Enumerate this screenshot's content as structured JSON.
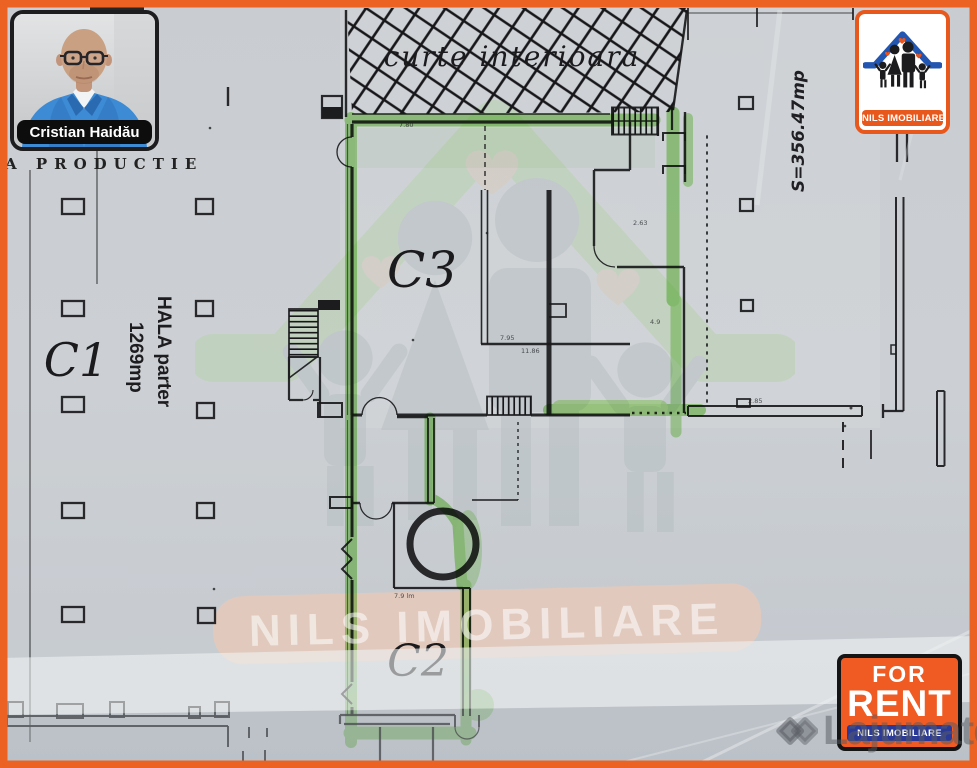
{
  "agent": {
    "name": "Cristian Haidău"
  },
  "brand": {
    "logo_banner": "NILS IMOBILIARE"
  },
  "badge": {
    "line1": "FOR",
    "line2": "RENT",
    "footer": "NILS IMOBILIARE"
  },
  "watermark": {
    "band_text": "NILS IMOBILIARE",
    "site_name": "Lajumate",
    "site_tld": ".ro"
  },
  "plan": {
    "courtyard_label": "curte interioara",
    "unit_c1": "C1",
    "unit_c2": "C2",
    "unit_c3": "C3",
    "hall_label_line1": "HALA parter",
    "hall_label_line2": "1269mp",
    "production_label": "A PRODUCTIE",
    "area_note": "S=356.47mp",
    "dims": [
      "7.80",
      "11.86",
      "7.95",
      "4.9",
      "2.63",
      "7.9 lm",
      "2.85"
    ]
  },
  "colors": {
    "frame_orange": "#ec6222",
    "brand_blue": "#2356b0",
    "highlighter_green": "#5ec629"
  }
}
